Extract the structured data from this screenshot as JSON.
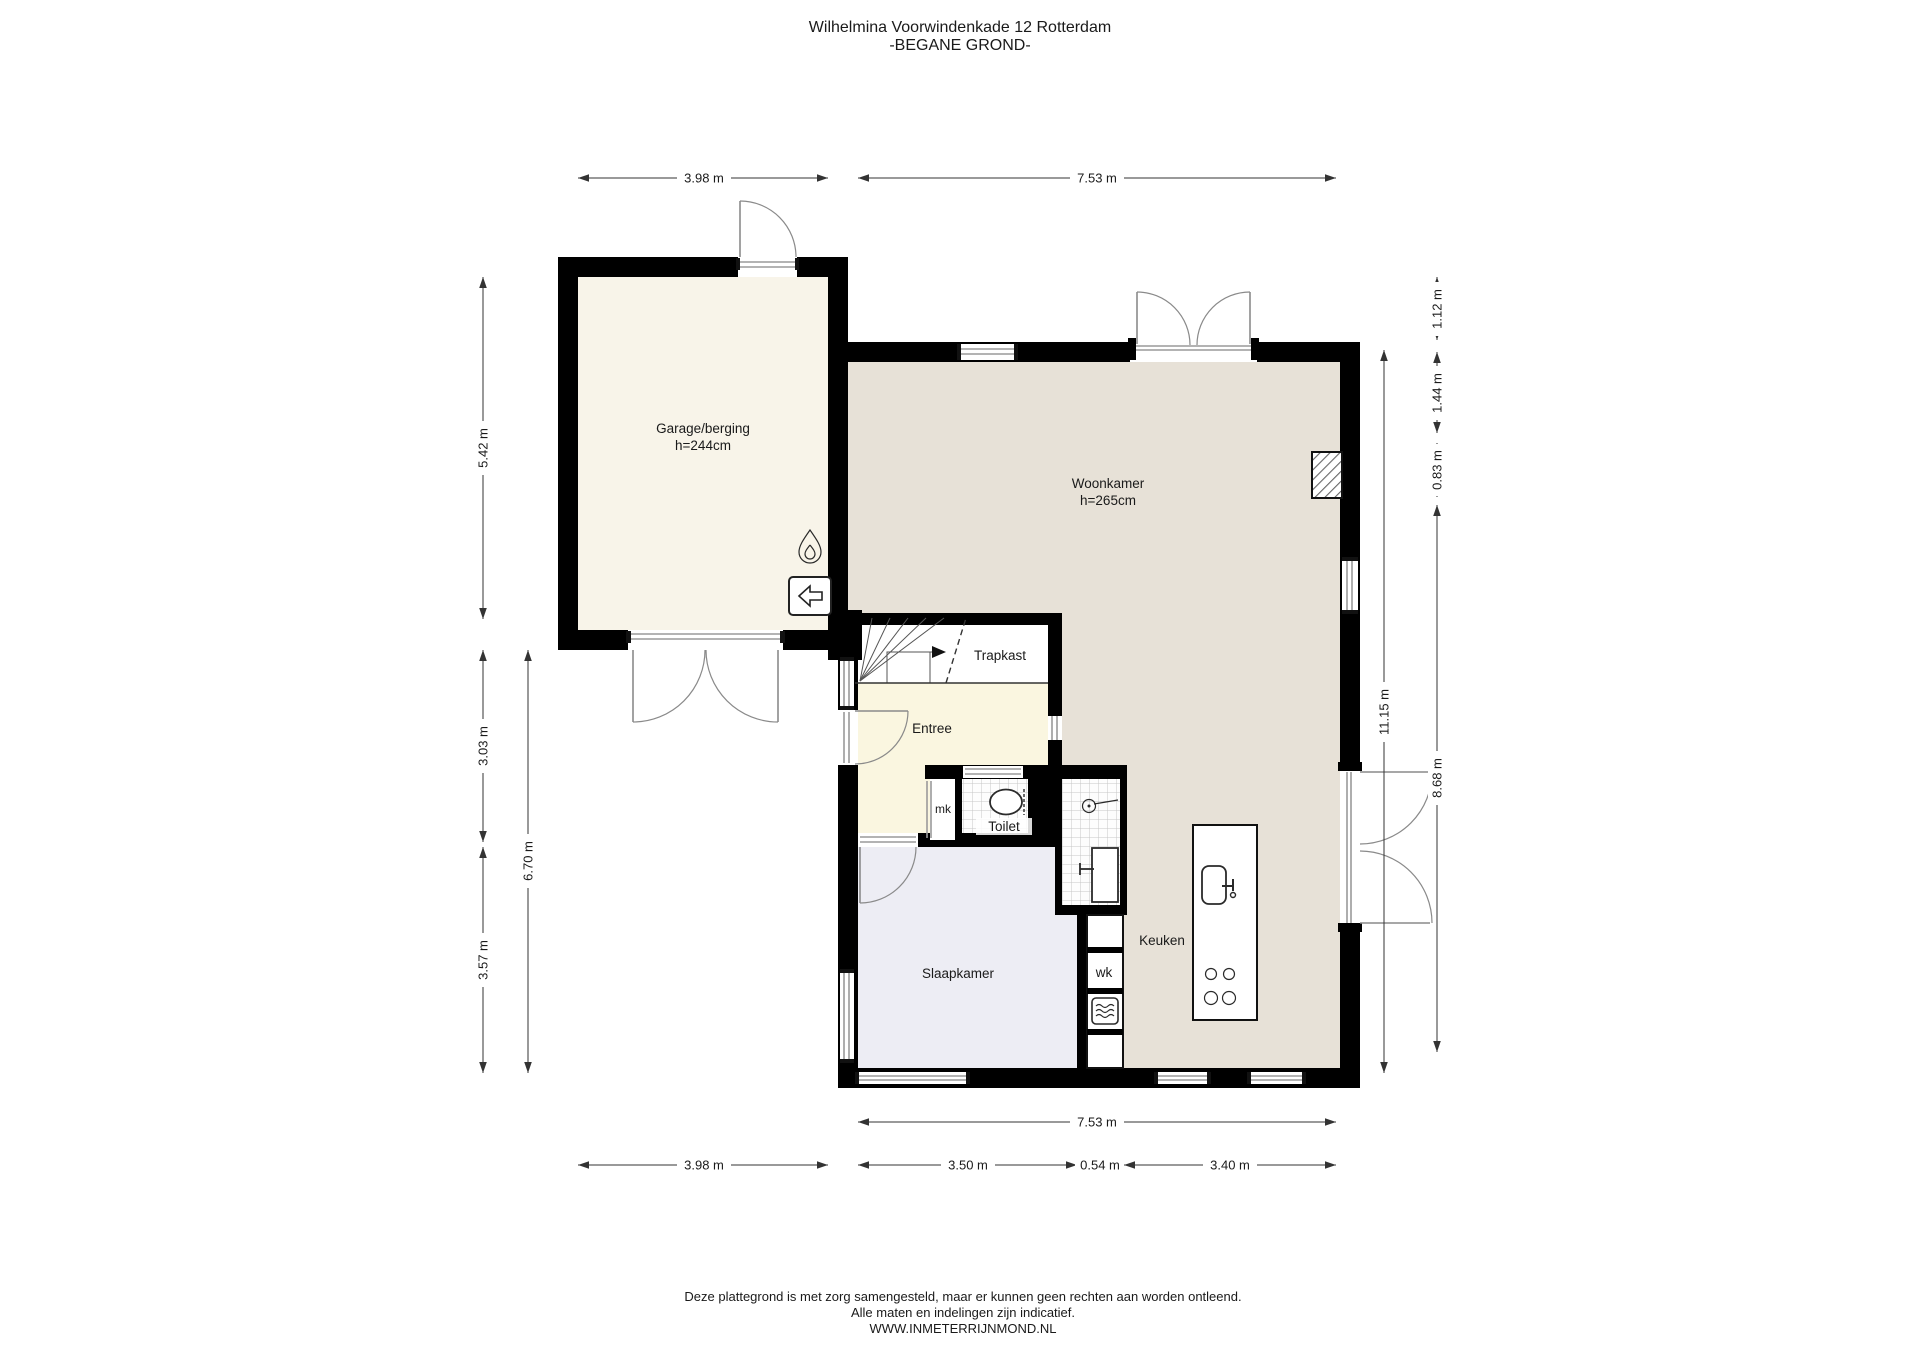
{
  "title": {
    "line1": "Wilhelmina Voorwindenkade 12 Rotterdam",
    "line2": "-BEGANE GROND-"
  },
  "rooms": {
    "garage": {
      "name": "Garage/berging",
      "height": "h=244cm"
    },
    "woonkamer": {
      "name": "Woonkamer",
      "height": "h=265cm"
    },
    "trapkast": "Trapkast",
    "entree": "Entree",
    "mk": "mk",
    "toilet": "Toilet",
    "slaapkamer": "Slaapkamer",
    "wk": "wk",
    "keuken": "Keuken"
  },
  "dimensions": {
    "top_garage": "3.98 m",
    "top_house": "7.53 m",
    "left_garage": "5.42 m",
    "left_entree": "3.03 m",
    "left_slaapkamer": "3.57 m",
    "left_total": "6.70 m",
    "right_seg1": "1.12 m",
    "right_seg2": "1.44 m",
    "right_seg3": "0.83 m",
    "right_inner": "11.15 m",
    "right_seg4": "8.68 m",
    "bottom_house": "7.53 m",
    "bottom_garage": "3.98 m",
    "bottom_slaapkamer": "3.50 m",
    "bottom_wk": "0.54 m",
    "bottom_keuken": "3.40 m"
  },
  "icons": {
    "garage_heater": "flame-icon",
    "garage_vent": "arrow-left-box-icon",
    "bathroom": "shower-icon",
    "kitchen_island": "sink-icon and cooktop-icon",
    "wk_appliance": "microwave-icon"
  },
  "colors": {
    "wall": "#000000",
    "woonkamer_floor": "#e7e1d7",
    "garage_floor": "#f8f4e9",
    "entree_floor": "#faf6e0",
    "slaapkamer_floor": "#ededf4",
    "dim_text": "#1a1a1a"
  },
  "footer": {
    "line1": "Deze plattegrond is met zorg samengesteld, maar er kunnen geen rechten aan worden ontleend.",
    "line2": "Alle maten en indelingen zijn indicatief.",
    "line3": "WWW.INMETERRIJNMOND.NL"
  }
}
